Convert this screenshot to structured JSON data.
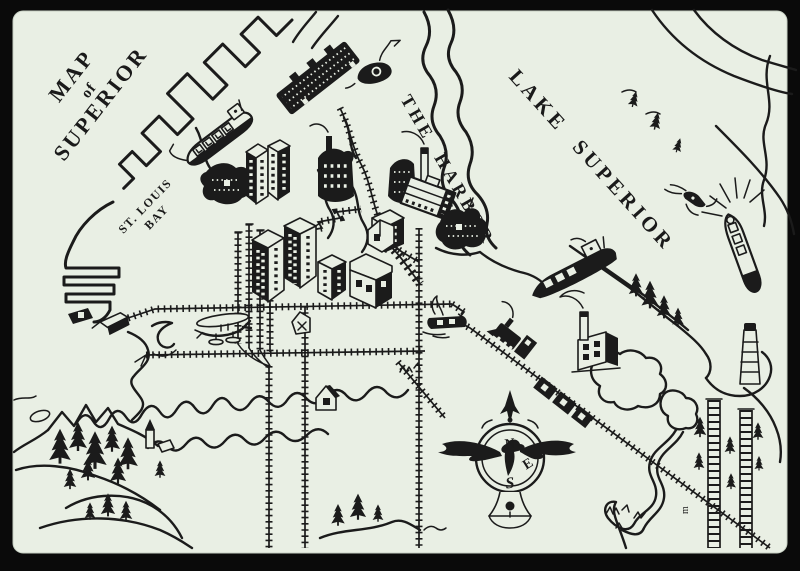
{
  "artwork": {
    "kind": "hand-drawn pictorial harbor map",
    "palette": {
      "paper": "#e9efe4",
      "ink": "#1b1b1b",
      "backdrop": "#0a0a0a"
    }
  },
  "labels": {
    "title": {
      "line1": "MAP",
      "line2": "of",
      "line3": "SUPERIOR"
    },
    "st_louis_bay": {
      "line1": "ST. LOUIS",
      "line2": "BAY"
    },
    "the_harbor": "THE HARBOR",
    "lake_superior": "LAKE SUPERIOR",
    "artist_mark": "m"
  },
  "compass": {
    "north": "N",
    "east": "E",
    "south": "S"
  },
  "icons": {
    "whaleback-freighter": "black-hulled ship with hatch squares at the docks",
    "tugboat": "small dark tug with smoke curl",
    "coal-dock": "dark speckled diagonal dock structure",
    "city-buildings": "isometric downtown blocks",
    "grain-elevator": "large white elevator with tall stack",
    "factory": "building with smoking chimney",
    "harbor-freighter": "dark freighter in the harbor",
    "lake-freighter": "white freighter with sun rays on the lake",
    "speedboat": "small boat with spray lines",
    "steam-locomotive": "engine with cowcatcher on diagonal track",
    "freight-cars": "boxcars on the rail line",
    "seaplane": "small plane over the rail yard",
    "drawbridge": "bridge crossing the bay narrows",
    "compass-rose": "ornate compass with eagle wings",
    "lighthouse": "tower at the end of the point",
    "ore-docks": "two long trestle docks, lower right",
    "forest-hill": "pine-covered hills, lower left",
    "river": "winding river, lower right",
    "hook-symbol": "small hook mark near the rail yard"
  }
}
